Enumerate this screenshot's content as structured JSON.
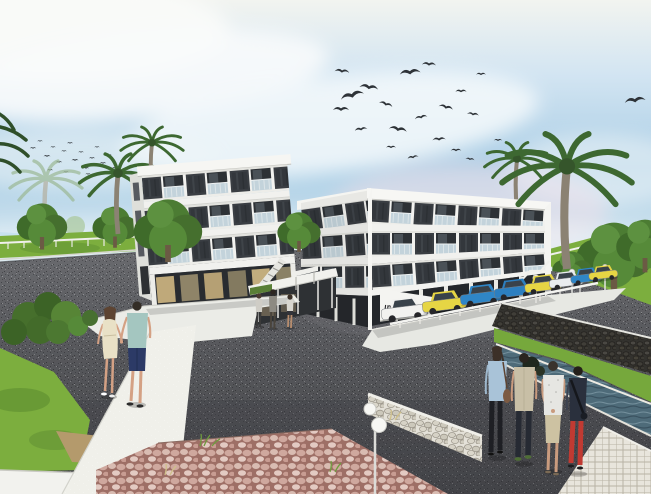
{
  "scene": {
    "alt": "Architectural rendering of a modern white apartment complex with palm trees, parked cars, pedestrians and flocks of birds"
  },
  "sign": {
    "text": "ımak evleri",
    "color": "#26262a"
  },
  "palette": {
    "sky_top": "#f2f4f0",
    "sky_blue": "#a9cde5",
    "cloud": "#f8fbfc",
    "pink_haze": "#f2dfe9",
    "asphalt": "#55565a",
    "grass": "#7cae3e",
    "tree_green": "#4c7c33",
    "palm_green": "#3d6831",
    "palm_trunk": "#8b8273",
    "building_white": "#f2f2ef",
    "panel_dark": "#3a3e43",
    "balcony_glass": "#c3d3db",
    "storefront_glass": "#c0ab7b",
    "plaza": "#ebece7",
    "stone_wall_light": "#e4e1d8",
    "stone_wall_dark": "#33322e",
    "paving_pink": "#9e6f66",
    "water": "#4e6b79",
    "walkway": "#e8e5dc",
    "lamp_white": "#f6f6f3"
  },
  "cars": {
    "count": 8,
    "colors": [
      "#f2f2f0",
      "#e6d544",
      "#2f86c7",
      "#2c7fc0",
      "#e6d544",
      "#e9ecee",
      "#2f86c7",
      "#e6d544"
    ],
    "window": "#39424a",
    "wheel": "#26262a"
  },
  "birds": {
    "flock_small_count": 18,
    "flock_large_count": 21,
    "color": "#2e3338"
  },
  "people": {
    "couple": {
      "woman_dress": "#e9e1c6",
      "woman_hair": "#5d4432",
      "man_shirt": "#a4c6c0",
      "man_shorts": "#2c3a66",
      "skin": "#d4a184"
    },
    "trio_count": 3,
    "group": [
      {
        "top": "#a9c3d8",
        "bottom": "#1e1f24",
        "bag": "#7c5a42"
      },
      {
        "top": "#c8bfa6",
        "bottom": "#262a33",
        "shoes": "#4e6e35"
      },
      {
        "top": "#e6e6e2",
        "bottom": "#cdc2a2"
      },
      {
        "top": "#2a303d",
        "bottom": "#c13a32"
      }
    ]
  }
}
